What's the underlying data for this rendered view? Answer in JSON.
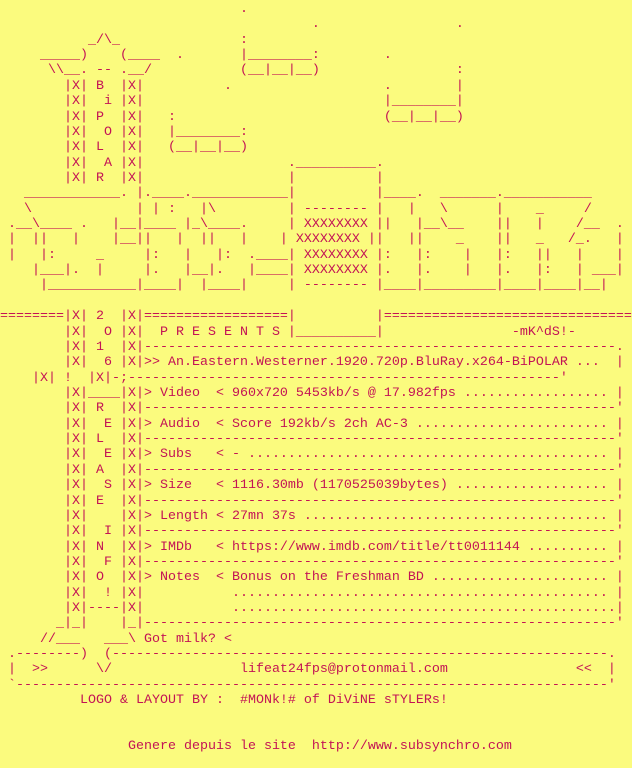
{
  "meta": {
    "background_color": "#FBFB7E",
    "text_color": "#C31355",
    "kind": "warez-scene-nfo-text-file"
  },
  "nfo": {
    "group_logo_vertical": "BiPOLAR",
    "rail_vertical_text": "2016! RELEASE INFO!",
    "presents": "P R E S E N T S",
    "tagger": "-mK^dS!-",
    "release_name": "An.Eastern.Westerner.1920.720p.BluRay.x264-BiPOLAR",
    "fields": {
      "video": "960x720 5453kb/s @ 17.982fps",
      "audio": "Score 192kb/s 2ch AC-3",
      "subs": "-",
      "size": "1116.30mb (1170525039bytes)",
      "length": "27mn 37s",
      "imdb": "https://www.imdb.com/title/tt0011144",
      "notes": "Bonus on the Freshman BD"
    },
    "got_milk": "Got milk? <",
    "email": "lifeat24fps@protonmail.com",
    "logo_credit": "LOGO & LAYOUT BY :  #MONk!# of DiViNE sTYLERs!",
    "generator": "Genere depuis le site  http://www.subsynchro.com",
    "ascii_lines": [
      "                              .",
      "                                       .                 .",
      "           _/\\_               :",
      "     _____)    (____  .       |________:        .",
      "      \\\\__. -- .__/           (__|__|__)                 :",
      "        |X| B  |X|          .                   .        |",
      "        |X|  i |X|                              |________|",
      "        |X| P  |X|   :                          (__|__|__)",
      "        |X|  O |X|   |________:",
      "        |X| L  |X|   (__|__|__)",
      "        |X|  A |X|                  .__________.",
      "        |X| R  |X|                  |          |",
      "   ____________. |.____.____________|          |____.  _______.___________",
      "   \\             | | :   |\\         | -------- |   |   \\      |    _     /",
      " .__\\____ .   |__|____ |_\\____.     | XXXXXXXX ||   |__\\__    ||   |    /__  .",
      " |  ||   |    |__||   |  ||   |    | XXXXXXXX ||   ||    _    ||   _   /_.   |",
      " |   |:     _     |:   |   |:  .____| XXXXXXXX |:   |:    |   |:   ||   |    |",
      "    |___|.  |     |.   |__|.   |____| XXXXXXXX |.   |.    |   |.   |:   | ___|",
      "     |___________|____|  |____|     | -------- |____|_________|____|____|__|",
      "",
      "========|X| 2  |X|==================|          |===============================",
      "        |X|  O |X|  P R E S E N T S |__________|                -mK^dS!-",
      "        |X| 1  |X|-----------------------------------------------------------.",
      "        |X|  6 |X|>> An.Eastern.Westerner.1920.720p.BluRay.x264-BiPOLAR ...  |",
      "    |X| !  |X|-;------------------------------------------------------'",
      "        |X|____|X|> Video  < 960x720 5453kb/s @ 17.982fps .................. |",
      "        |X| R  |X|-----------------------------------------------------------'",
      "        |X|  E |X|> Audio  < Score 192kb/s 2ch AC-3 ........................ |",
      "        |X| L  |X|-----------------------------------------------------------'",
      "        |X|  E |X|> Subs   < - ............................................. |",
      "        |X| A  |X|-----------------------------------------------------------'",
      "        |X|  S |X|> Size   < 1116.30mb (1170525039bytes) ................... |",
      "        |X| E  |X|-----------------------------------------------------------'",
      "        |X|    |X|> Length < 27mn 37s ...................................... |",
      "        |X|  I |X|-----------------------------------------------------------'",
      "        |X| N  |X|> IMDb   < https://www.imdb.com/title/tt0011144 .......... |",
      "        |X|  F |X|-----------------------------------------------------------'",
      "        |X| O  |X|> Notes  < Bonus on the Freshman BD ...................... |",
      "        |X|  ! |X|           ............................................... |",
      "        |X|----|X|           ................................................|",
      "       _|_|    |_|-----------------------------------------------------------'",
      "     //___   ___\\ Got milk? <",
      " .--------)  (--------------------------------------------------------------.",
      " |  >>      \\/                lifeat24fps@protonmail.com                <<  |",
      " `--------------------------------------------------------------------------'",
      "          LOGO & LAYOUT BY :  #MONk!# of DiViNE sTYLERs!",
      "",
      "",
      "                Genere depuis le site  http://www.subsynchro.com",
      ""
    ]
  }
}
